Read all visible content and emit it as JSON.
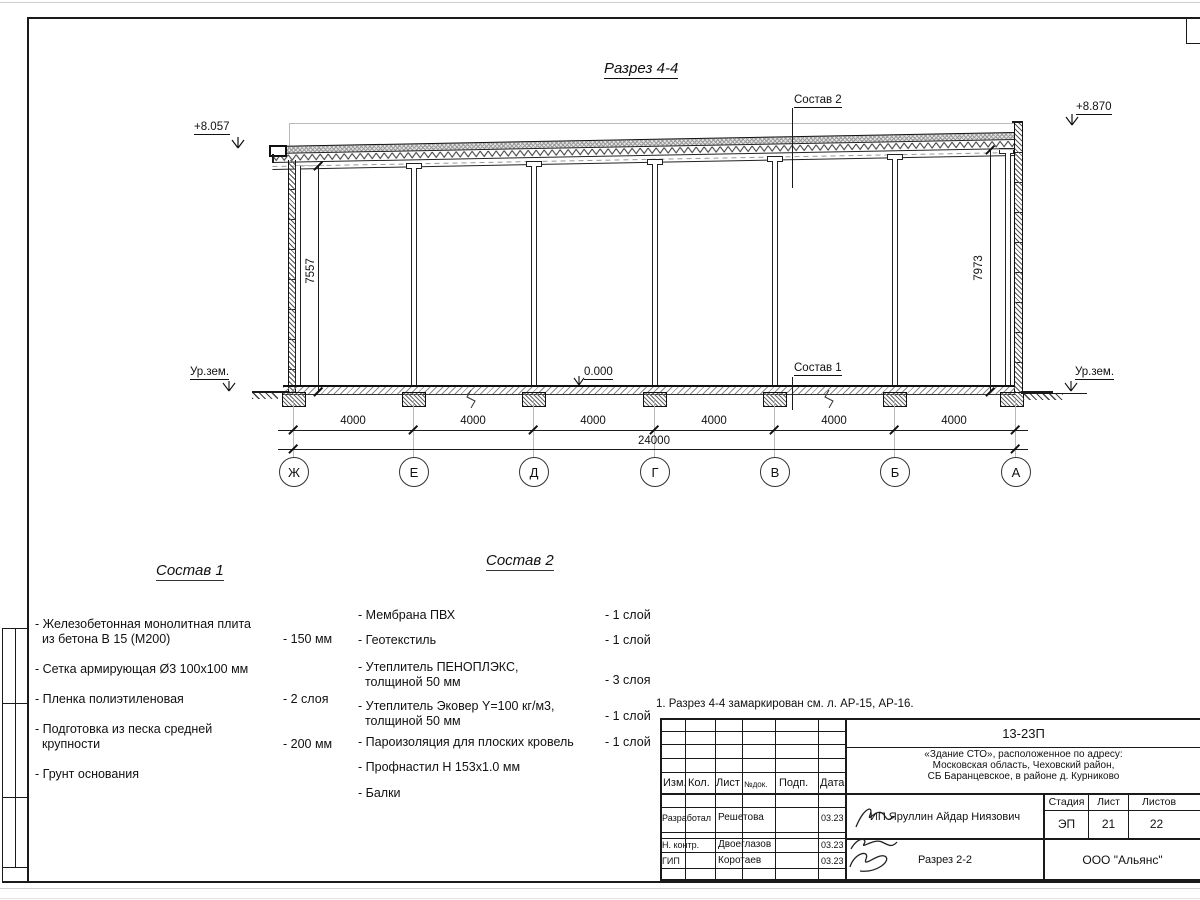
{
  "drawing": {
    "section_title": "Разрез 4-4",
    "elev_left": "+8.057",
    "elev_right": "+8.870",
    "elev_floor": "0.000",
    "ground_left": "Ур.зем.",
    "ground_right": "Ур.зем.",
    "leader_sostav2": "Состав 2",
    "leader_sostav1": "Состав 1",
    "dim_left": "7557",
    "dim_right": "7973",
    "axes": [
      "Ж",
      "Е",
      "Д",
      "Г",
      "В",
      "Б",
      "А"
    ],
    "bay_dims": [
      "4000",
      "4000",
      "4000",
      "4000",
      "4000",
      "4000"
    ],
    "total_dim": "24000"
  },
  "comp1": {
    "title": "Состав 1",
    "items": [
      {
        "line1": "Железобетонная  монолитная плита",
        "line2": "из бетона В 15 (М200)",
        "value": "- 150 мм"
      },
      {
        "line1": "Сетка армирующая Ø3 100х100 мм",
        "line2": "",
        "value": ""
      },
      {
        "line1": "Пленка полиэтиленовая",
        "line2": "",
        "value": "-  2 слоя"
      },
      {
        "line1": "Подготовка из песка средней",
        "line2": "крупности",
        "value": "- 200 мм"
      },
      {
        "line1": "Грунт основания",
        "line2": "",
        "value": ""
      }
    ]
  },
  "comp2": {
    "title": "Состав 2",
    "items": [
      {
        "line1": "Мембрана ПВХ",
        "line2": "",
        "value": "- 1 слой"
      },
      {
        "line1": "Геотекстиль",
        "line2": "",
        "value": "- 1 слой"
      },
      {
        "line1": "Утеплитель ПЕНОПЛЭКС,",
        "line2": "толщиной 50 мм",
        "value": "- 3 слоя"
      },
      {
        "line1": "Утеплитель Эковер Y=100 кг/м3,",
        "line2": "толщиной 50 мм",
        "value": "- 1 слой"
      },
      {
        "line1": "Пароизоляция для плоских кровель",
        "line2": "",
        "value": "- 1 слой"
      },
      {
        "line1": "Профнастил Н 153х1.0 мм",
        "line2": "",
        "value": ""
      },
      {
        "line1": "Балки",
        "line2": "",
        "value": ""
      }
    ]
  },
  "note": "1. Разрез 4-4 замаркирован см. л. АР-15, АР-16.",
  "titleblock": {
    "doc_number": "13-23П",
    "project_line1": "«Здание СТО», расположенное по адресу:",
    "project_line2": "Московская область, Чеховский район,",
    "project_line3": "СБ Баранцевское, в районе д. Курниково",
    "col_izm": "Изм.",
    "col_kol": "Кол.",
    "col_list": "Лист",
    "col_ndok": "№док.",
    "col_podp": "Подп.",
    "col_data": "Дата",
    "row1_role": "Разработал",
    "row1_name": "Решетова",
    "row1_date": "03.23",
    "row2_role": "Н. контр.",
    "row2_name": "Двоеглазов",
    "row2_date": "03.23",
    "row3_role": "ГИП",
    "row3_name": "Коротаев",
    "row3_date": "03.23",
    "client": "ИП Яруллин Айдар Ниязович",
    "stage_label": "Стадия",
    "sheet_label": "Лист",
    "sheets_label": "Листов",
    "stage": "ЭП",
    "sheet": "21",
    "sheets": "22",
    "sheet_title": "Разрез 2-2",
    "company": "ООО \"Альянс\""
  }
}
